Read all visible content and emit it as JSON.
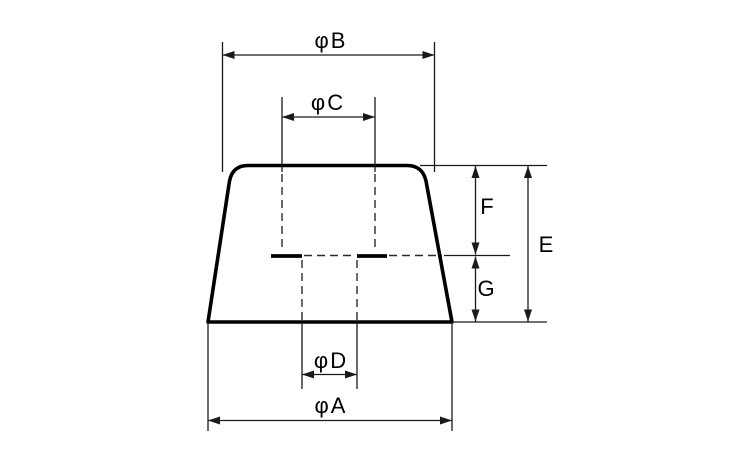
{
  "diagram": {
    "background_color": "#ffffff",
    "outline_color": "#000000",
    "dimension_line_color": "#1a1a1a",
    "dimensions": {
      "phi_b": {
        "label": "φB",
        "orientation": "horizontal"
      },
      "phi_c": {
        "label": "φC",
        "orientation": "horizontal"
      },
      "phi_d": {
        "label": "φD",
        "orientation": "horizontal"
      },
      "phi_a": {
        "label": "φA",
        "orientation": "horizontal"
      },
      "e": {
        "label": "E",
        "orientation": "vertical"
      },
      "f": {
        "label": "F",
        "orientation": "vertical"
      },
      "g": {
        "label": "G",
        "orientation": "vertical"
      }
    }
  }
}
